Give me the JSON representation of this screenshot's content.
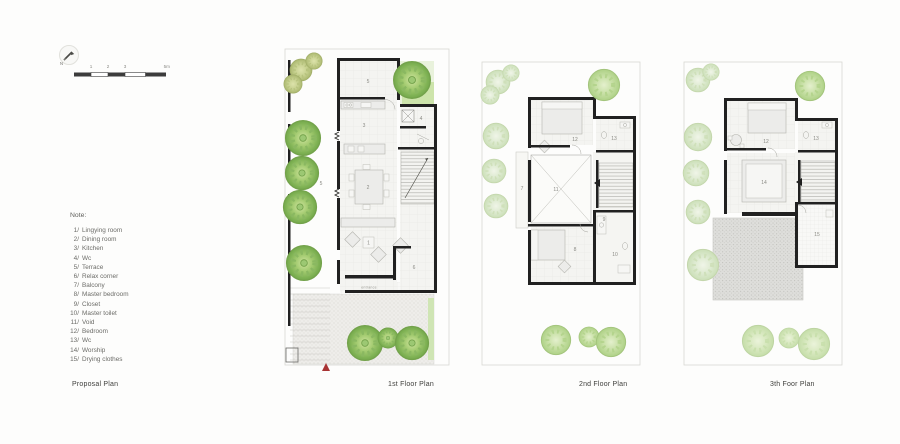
{
  "north_indicator": {
    "label": "N"
  },
  "scale_bar": {
    "ticks": [
      "1",
      "2",
      "3"
    ],
    "unit_label": "5m"
  },
  "notes": {
    "title": "Note:",
    "items": [
      {
        "num": "1/",
        "label": "Lingying room"
      },
      {
        "num": "2/",
        "label": "Dining room"
      },
      {
        "num": "3/",
        "label": "Kitchen"
      },
      {
        "num": "4/",
        "label": "Wc"
      },
      {
        "num": "5/",
        "label": "Terrace"
      },
      {
        "num": "6/",
        "label": "Relax corner"
      },
      {
        "num": "7/",
        "label": "Balcony"
      },
      {
        "num": "8/",
        "label": "Master bedroom"
      },
      {
        "num": "9/",
        "label": "Closet"
      },
      {
        "num": "10/",
        "label": "Master toilet"
      },
      {
        "num": "11/",
        "label": "Void"
      },
      {
        "num": "12/",
        "label": "Bedroom"
      },
      {
        "num": "13/",
        "label": "Wc"
      },
      {
        "num": "14/",
        "label": "Worship"
      },
      {
        "num": "15/",
        "label": "Drying clothes"
      }
    ]
  },
  "titles": {
    "proposal": "Proposal Plan",
    "first": "1st Floor Plan",
    "second": "2nd Floor Plan",
    "third": "3th Foor Plan"
  },
  "plans": {
    "first": {
      "entrance_label": "entrance",
      "room_labels": {
        "terrace": "5",
        "side_terrace": "5",
        "kitchen": "3",
        "wc": "4",
        "dining": "2",
        "living": "1",
        "relax_corner": "6"
      }
    },
    "second": {
      "room_labels": {
        "balcony": "7",
        "void": "11",
        "bedroom": "12",
        "wc": "13",
        "master_bedroom": "8",
        "closet": "9",
        "master_toilet": "10"
      }
    },
    "third": {
      "room_labels": {
        "bedroom": "12",
        "wc": "13",
        "worship": "14",
        "drying": "15"
      }
    }
  },
  "colors": {
    "wall": "#212121",
    "tree_bright": "#7fb254",
    "tree_faded": "#dcead0",
    "lawn": "#cde4ab",
    "marker_red": "#a83434"
  }
}
